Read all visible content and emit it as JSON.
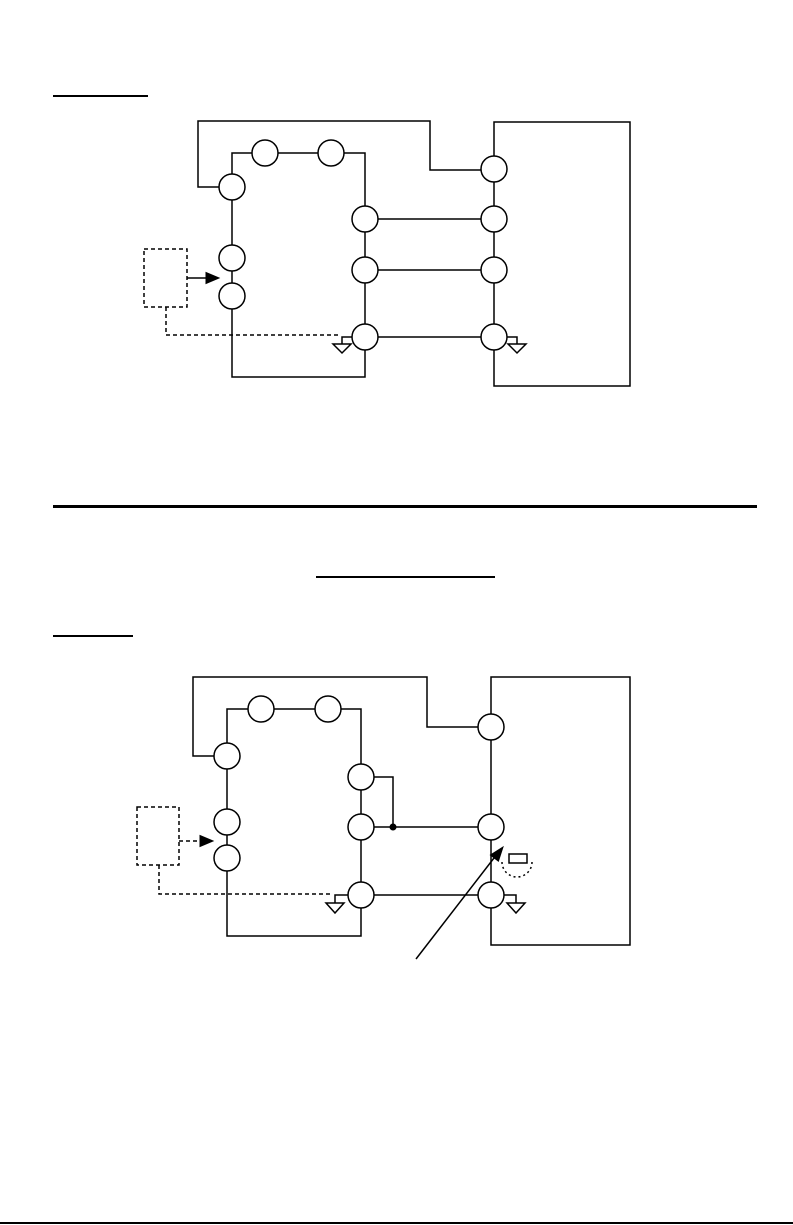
{
  "document": {
    "background": "#ffffff",
    "ink_color": "#000000",
    "rules": [
      {
        "name": "heading1-underline",
        "x": 53,
        "y": 95,
        "width": 95,
        "height": 2
      },
      {
        "name": "section-divider",
        "x": 53,
        "y": 505,
        "width": 704,
        "height": 3
      },
      {
        "name": "title-underline",
        "x": 316,
        "y": 576,
        "width": 179,
        "height": 2
      },
      {
        "name": "heading2-underline",
        "x": 53,
        "y": 635,
        "width": 80,
        "height": 2
      },
      {
        "name": "page-bottom-edge",
        "x": 0,
        "y": 1222,
        "width": 793,
        "height": 2
      }
    ]
  },
  "diagrams": [
    {
      "name": "wiring-diagram-1",
      "strokes": [
        {
          "name": "equipment-box",
          "type": "rect",
          "x": 494,
          "y": 122,
          "w": 136,
          "h": 264
        },
        {
          "name": "controller-box",
          "type": "rect",
          "x": 232,
          "y": 153,
          "w": 133,
          "h": 224
        },
        {
          "name": "supply-wire",
          "type": "polyline",
          "points": [
            [
              219,
              187
            ],
            [
              198,
              187
            ],
            [
              198,
              121
            ],
            [
              430,
              121
            ],
            [
              430,
              170
            ],
            [
              481,
              170
            ]
          ]
        },
        {
          "name": "wire-1",
          "type": "polyline",
          "points": [
            [
              378,
              219
            ],
            [
              481,
              219
            ]
          ]
        },
        {
          "name": "wire-2",
          "type": "polyline",
          "points": [
            [
              378,
              270
            ],
            [
              481,
              270
            ]
          ]
        },
        {
          "name": "wire-3",
          "type": "polyline",
          "points": [
            [
              378,
              337
            ],
            [
              481,
              337
            ]
          ]
        },
        {
          "name": "sensor-box",
          "type": "rect",
          "x": 144,
          "y": 249,
          "w": 43,
          "h": 58,
          "dashed": true
        },
        {
          "name": "sensor-arrow-line",
          "type": "polyline",
          "points": [
            [
              187,
              278
            ],
            [
              207,
              278
            ]
          ]
        },
        {
          "name": "sensor-lead",
          "type": "polyline",
          "points": [
            [
              166,
              307
            ],
            [
              166,
              335
            ],
            [
              341,
              335
            ]
          ],
          "dashed": true
        },
        {
          "name": "ground-left-stub",
          "type": "polyline",
          "points": [
            [
              352,
              337
            ],
            [
              342,
              337
            ],
            [
              342,
              344
            ]
          ]
        },
        {
          "name": "ground-left-triangle",
          "type": "polygon",
          "points": [
            [
              333,
              344
            ],
            [
              351,
              344
            ],
            [
              342,
              353
            ]
          ]
        },
        {
          "name": "ground-right-stub",
          "type": "polyline",
          "points": [
            [
              507,
              337
            ],
            [
              517,
              337
            ],
            [
              517,
              344
            ]
          ]
        },
        {
          "name": "ground-right-triangle",
          "type": "polygon",
          "points": [
            [
              508,
              344
            ],
            [
              526,
              344
            ],
            [
              517,
              353
            ]
          ]
        },
        {
          "name": "terminal",
          "type": "circle",
          "cx": 265,
          "cy": 153,
          "r": 13
        },
        {
          "name": "terminal",
          "type": "circle",
          "cx": 331,
          "cy": 153,
          "r": 13
        },
        {
          "name": "terminal",
          "type": "circle",
          "cx": 232,
          "cy": 187,
          "r": 13
        },
        {
          "name": "terminal",
          "type": "circle",
          "cx": 232,
          "cy": 258,
          "r": 13
        },
        {
          "name": "terminal",
          "type": "circle",
          "cx": 232,
          "cy": 296,
          "r": 13
        },
        {
          "name": "terminal",
          "type": "circle",
          "cx": 365,
          "cy": 219,
          "r": 13
        },
        {
          "name": "terminal",
          "type": "circle",
          "cx": 365,
          "cy": 270,
          "r": 13
        },
        {
          "name": "terminal",
          "type": "circle",
          "cx": 365,
          "cy": 337,
          "r": 13
        },
        {
          "name": "terminal",
          "type": "circle",
          "cx": 494,
          "cy": 169,
          "r": 13
        },
        {
          "name": "terminal",
          "type": "circle",
          "cx": 494,
          "cy": 219,
          "r": 13
        },
        {
          "name": "terminal",
          "type": "circle",
          "cx": 494,
          "cy": 270,
          "r": 13
        },
        {
          "name": "terminal",
          "type": "circle",
          "cx": 494,
          "cy": 337,
          "r": 13
        },
        {
          "name": "sensor-arrow-head",
          "type": "polygon",
          "points": [
            [
              219,
              278
            ],
            [
              206,
              272.5
            ],
            [
              206,
              283.5
            ]
          ],
          "filled": true
        }
      ]
    },
    {
      "name": "wiring-diagram-2",
      "strokes": [
        {
          "name": "equipment-box",
          "type": "rect",
          "x": 491,
          "y": 677,
          "w": 139,
          "h": 268
        },
        {
          "name": "controller-box",
          "type": "rect",
          "x": 227,
          "y": 709,
          "w": 134,
          "h": 227
        },
        {
          "name": "supply-wire",
          "type": "polyline",
          "points": [
            [
              214,
              756
            ],
            [
              193,
              756
            ],
            [
              193,
              677
            ],
            [
              427,
              677
            ],
            [
              427,
              727
            ],
            [
              478,
              727
            ]
          ]
        },
        {
          "name": "tap-wire",
          "type": "polyline",
          "points": [
            [
              374,
              777
            ],
            [
              393,
              777
            ],
            [
              393,
              827
            ]
          ]
        },
        {
          "name": "wire-mid",
          "type": "polyline",
          "points": [
            [
              374,
              827
            ],
            [
              478,
              827
            ]
          ]
        },
        {
          "name": "wire-bottom",
          "type": "polyline",
          "points": [
            [
              374,
              895
            ],
            [
              478,
              895
            ]
          ]
        },
        {
          "name": "sensor-box",
          "type": "rect",
          "x": 137,
          "y": 807,
          "w": 42,
          "h": 58,
          "dashed": true
        },
        {
          "name": "sensor-arrow-line",
          "type": "polyline",
          "points": [
            [
              179,
              841
            ],
            [
              200,
              841
            ]
          ],
          "dashed": true
        },
        {
          "name": "sensor-lead",
          "type": "polyline",
          "points": [
            [
              159,
              865
            ],
            [
              159,
              894
            ],
            [
              333,
              894
            ]
          ],
          "dashed": true
        },
        {
          "name": "ground-left-stub",
          "type": "polyline",
          "points": [
            [
              348,
              895
            ],
            [
              335,
              895
            ],
            [
              335,
              903
            ]
          ]
        },
        {
          "name": "ground-left-triangle",
          "type": "polygon",
          "points": [
            [
              326,
              903
            ],
            [
              344,
              903
            ],
            [
              335,
              913
            ]
          ]
        },
        {
          "name": "ground-right-stub",
          "type": "polyline",
          "points": [
            [
              504,
              895
            ],
            [
              516,
              895
            ],
            [
              516,
              903
            ]
          ]
        },
        {
          "name": "ground-right-triangle",
          "type": "polygon",
          "points": [
            [
              507,
              903
            ],
            [
              525,
              903
            ],
            [
              516,
              913
            ]
          ]
        },
        {
          "name": "adjustment-pointer-line",
          "type": "polyline",
          "points": [
            [
              416,
              959
            ],
            [
              494,
              858
            ]
          ]
        },
        {
          "name": "screw-symbol",
          "type": "rect",
          "x": 509,
          "y": 854,
          "w": 18,
          "h": 9
        },
        {
          "name": "rotation-arc",
          "type": "arc",
          "d": "M 502 862 A 15 15 0 0 0 532 862",
          "dashed": true,
          "dash": "2,3"
        },
        {
          "name": "terminal",
          "type": "circle",
          "cx": 261,
          "cy": 709,
          "r": 13
        },
        {
          "name": "terminal",
          "type": "circle",
          "cx": 328,
          "cy": 709,
          "r": 13
        },
        {
          "name": "terminal",
          "type": "circle",
          "cx": 227,
          "cy": 756,
          "r": 13
        },
        {
          "name": "terminal",
          "type": "circle",
          "cx": 227,
          "cy": 822,
          "r": 13
        },
        {
          "name": "terminal",
          "type": "circle",
          "cx": 227,
          "cy": 858,
          "r": 13
        },
        {
          "name": "terminal",
          "type": "circle",
          "cx": 361,
          "cy": 777,
          "r": 13
        },
        {
          "name": "terminal",
          "type": "circle",
          "cx": 361,
          "cy": 827,
          "r": 13
        },
        {
          "name": "terminal",
          "type": "circle",
          "cx": 361,
          "cy": 895,
          "r": 13
        },
        {
          "name": "terminal",
          "type": "circle",
          "cx": 491,
          "cy": 727,
          "r": 13
        },
        {
          "name": "terminal",
          "type": "circle",
          "cx": 491,
          "cy": 827,
          "r": 13
        },
        {
          "name": "terminal",
          "type": "circle",
          "cx": 491,
          "cy": 895,
          "r": 13
        },
        {
          "name": "junction-dot",
          "type": "dot",
          "cx": 393,
          "cy": 827,
          "r": 3.5
        },
        {
          "name": "sensor-arrow-head",
          "type": "polygon",
          "points": [
            [
              213,
              841
            ],
            [
              200,
              835.5
            ],
            [
              200,
              846.5
            ]
          ],
          "filled": true
        },
        {
          "name": "adjustment-pointer-head",
          "type": "polygon",
          "points": [
            [
              503,
              847
            ],
            [
              498.4,
              861.2
            ],
            [
              490.4,
              855
            ]
          ],
          "filled": true
        }
      ]
    }
  ]
}
